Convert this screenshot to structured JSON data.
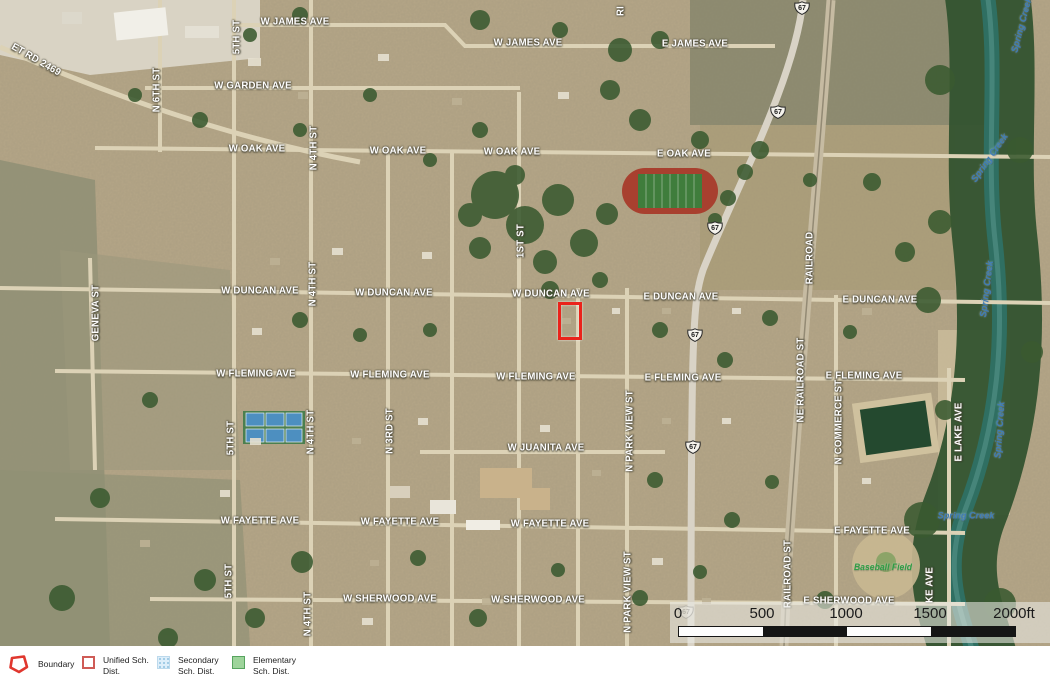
{
  "map": {
    "highway_shields": {
      "route": "67",
      "positions": [
        {
          "x": 802,
          "y": 8
        },
        {
          "x": 778,
          "y": 112
        },
        {
          "x": 715,
          "y": 228
        },
        {
          "x": 695,
          "y": 335
        },
        {
          "x": 693,
          "y": 447
        },
        {
          "x": 686,
          "y": 612,
          "faint": true
        }
      ]
    },
    "boundary_rect": {
      "x": 558,
      "y": 302,
      "w": 18,
      "h": 32
    },
    "labels": [
      {
        "text": "W JAMES AVE",
        "x": 295,
        "y": 22
      },
      {
        "text": "W JAMES AVE",
        "x": 528,
        "y": 43
      },
      {
        "text": "E JAMES AVE",
        "x": 695,
        "y": 44
      },
      {
        "text": "W GARDEN AVE",
        "x": 253,
        "y": 86
      },
      {
        "text": "ET RD 2469",
        "x": 36,
        "y": 60,
        "rot": 30
      },
      {
        "text": "RI",
        "x": 621,
        "y": 11,
        "rot": -90
      },
      {
        "text": "W OAK AVE",
        "x": 257,
        "y": 149
      },
      {
        "text": "W OAK AVE",
        "x": 398,
        "y": 151
      },
      {
        "text": "W OAK AVE",
        "x": 512,
        "y": 152
      },
      {
        "text": "E OAK AVE",
        "x": 684,
        "y": 154
      },
      {
        "text": "W DUNCAN AVE",
        "x": 260,
        "y": 291
      },
      {
        "text": "W DUNCAN AVE",
        "x": 394,
        "y": 293
      },
      {
        "text": "W DUNCAN AVE",
        "x": 551,
        "y": 294
      },
      {
        "text": "E DUNCAN AVE",
        "x": 681,
        "y": 297
      },
      {
        "text": "E DUNCAN AVE",
        "x": 880,
        "y": 300
      },
      {
        "text": "W FLEMING AVE",
        "x": 256,
        "y": 374
      },
      {
        "text": "W FLEMING AVE",
        "x": 390,
        "y": 375
      },
      {
        "text": "W FLEMING AVE",
        "x": 536,
        "y": 377
      },
      {
        "text": "E FLEMING AVE",
        "x": 683,
        "y": 378
      },
      {
        "text": "E FLEMING AVE",
        "x": 864,
        "y": 376
      },
      {
        "text": "W JUANITA AVE",
        "x": 546,
        "y": 448
      },
      {
        "text": "W FAYETTE AVE",
        "x": 260,
        "y": 521
      },
      {
        "text": "W FAYETTE AVE",
        "x": 400,
        "y": 522
      },
      {
        "text": "W FAYETTE AVE",
        "x": 550,
        "y": 524
      },
      {
        "text": "E FAYETTE AVE",
        "x": 872,
        "y": 531
      },
      {
        "text": "W SHERWOOD AVE",
        "x": 390,
        "y": 599
      },
      {
        "text": "W SHERWOOD AVE",
        "x": 538,
        "y": 600
      },
      {
        "text": "E SHERWOOD AVE",
        "x": 849,
        "y": 601
      },
      {
        "text": "N 6TH ST",
        "x": 157,
        "y": 90,
        "rot": -90
      },
      {
        "text": "5TH ST",
        "x": 237,
        "y": 37,
        "rot": -90
      },
      {
        "text": "5TH ST",
        "x": 231,
        "y": 438,
        "rot": -90
      },
      {
        "text": "5TH ST",
        "x": 229,
        "y": 581,
        "rot": -90
      },
      {
        "text": "N 4TH ST",
        "x": 314,
        "y": 148,
        "rot": -90
      },
      {
        "text": "N 4TH ST",
        "x": 313,
        "y": 284,
        "rot": -90
      },
      {
        "text": "N 4TH ST",
        "x": 311,
        "y": 432,
        "rot": -90
      },
      {
        "text": "N 4TH ST",
        "x": 308,
        "y": 614,
        "rot": -90
      },
      {
        "text": "N 3RD ST",
        "x": 390,
        "y": 431,
        "rot": -90
      },
      {
        "text": "1ST ST",
        "x": 521,
        "y": 241,
        "rot": -90
      },
      {
        "text": "GENEVA ST",
        "x": 96,
        "y": 313,
        "rot": -90
      },
      {
        "text": "N PARK VIEW ST",
        "x": 630,
        "y": 431,
        "rot": -90
      },
      {
        "text": "N PARK VIEW ST",
        "x": 628,
        "y": 592,
        "rot": -90
      },
      {
        "text": "NE RAILROAD ST",
        "x": 801,
        "y": 380,
        "rot": -90
      },
      {
        "text": "RAILROAD ST",
        "x": 788,
        "y": 574,
        "rot": -90
      },
      {
        "text": "RAILROAD",
        "x": 810,
        "y": 258,
        "rot": -90
      },
      {
        "text": "N COMMERCE ST",
        "x": 839,
        "y": 422,
        "rot": -90
      },
      {
        "text": "E LAKE AVE",
        "x": 959,
        "y": 432,
        "rot": -90
      },
      {
        "text": "KE AVE",
        "x": 930,
        "y": 585,
        "rot": -90
      },
      {
        "text": "Spring Creek",
        "x": 1022,
        "y": 25,
        "rot": -75,
        "kind": "water"
      },
      {
        "text": "Spring Creek",
        "x": 990,
        "y": 158,
        "rot": -55,
        "kind": "water"
      },
      {
        "text": "Spring Creek",
        "x": 987,
        "y": 289,
        "rot": -83,
        "kind": "water"
      },
      {
        "text": "Spring Creek",
        "x": 1000,
        "y": 430,
        "rot": -86,
        "kind": "water"
      },
      {
        "text": "Spring Creek",
        "x": 966,
        "y": 516,
        "rot": 0,
        "kind": "water"
      },
      {
        "text": "Baseball Field",
        "x": 883,
        "y": 567,
        "kind": "poi"
      }
    ]
  },
  "scale_bar": {
    "ticks": [
      "0",
      "500",
      "1000",
      "1500"
    ],
    "end_label": "2000ft"
  },
  "legend": {
    "items": [
      {
        "key": "boundary",
        "label": "Boundary"
      },
      {
        "key": "unified",
        "label": "Unified Sch. Dist."
      },
      {
        "key": "secondary",
        "label": "Secondary Sch. Dist."
      },
      {
        "key": "elementary",
        "label": "Elementary Sch. Dist."
      }
    ]
  },
  "colors": {
    "boundary_red": "#ea231b",
    "unified_border": "#cf5b56",
    "secondary_blue": "#ddeefa",
    "elementary_green": "#9ed49b",
    "creek_label_blue": "#3f7cb6",
    "baseball_label_green": "#2f9e44"
  }
}
